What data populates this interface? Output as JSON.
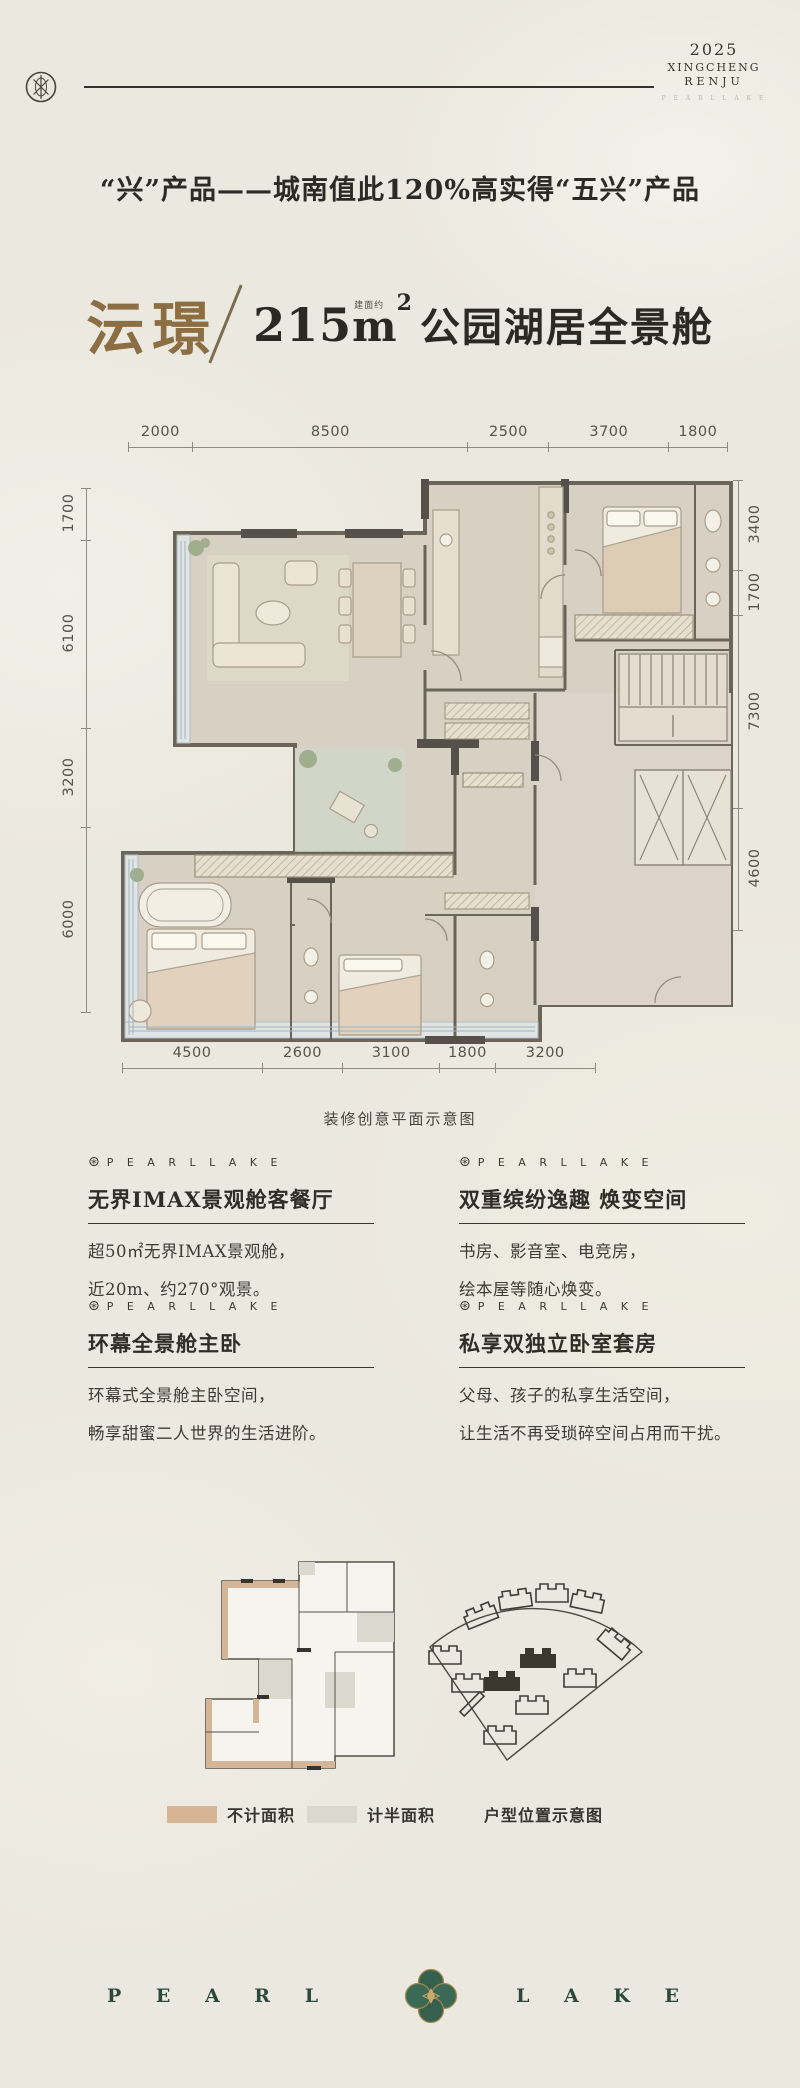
{
  "header": {
    "year": "2025",
    "brand1": "XINGCHENG",
    "brand2": "RENJU",
    "tagline": "P E A R L   L A K E"
  },
  "headline": {
    "text": "“兴”产品——城南值此120%高实得“五兴”产品"
  },
  "title": {
    "name": "沄璟",
    "area": "215",
    "area_note": "建面约",
    "unit": "m",
    "sup": "2",
    "desc": "公园湖居全景舱"
  },
  "floorplan": {
    "caption": "装修创意平面示意图",
    "dims_top": [
      "2000",
      "8500",
      "2500",
      "3700",
      "1800"
    ],
    "dims_left": [
      "1700",
      "6100",
      "3200",
      "6000"
    ],
    "dims_right": [
      "3400",
      "1700",
      "7300",
      "4600"
    ],
    "dims_bottom": [
      "4500",
      "2600",
      "3100",
      "1800",
      "3200"
    ]
  },
  "features": [
    {
      "brand": "P E A R L  L A K E",
      "title": "无界IMAX景观舱客餐厅",
      "line1": "超50㎡无界IMAX景观舱，",
      "line2": "近20m、约270°观景。"
    },
    {
      "brand": "P E A R L  L A K E",
      "title": "双重缤纷逸趣 焕变空间",
      "line1": "书房、影音室、电竞房，",
      "line2": "绘本屋等随心焕变。"
    },
    {
      "brand": "P E A R L  L A K E",
      "title": "环幕全景舱主卧",
      "line1": "环幕式全景舱主卧空间，",
      "line2": "畅享甜蜜二人世界的生活进阶。"
    },
    {
      "brand": "P E A R L  L A K E",
      "title": "私享双独立卧室套房",
      "line1": "父母、孩子的私享生活空间，",
      "line2": "让生活不再受琐碎空间占用而干扰。"
    }
  ],
  "legend": {
    "items": [
      {
        "label": "不计面积",
        "color": "#d6b596"
      },
      {
        "label": "计半面积",
        "color": "#dbd8d0"
      }
    ],
    "site_label": "户型位置示意图"
  },
  "footer": {
    "left": "P E A R L",
    "right": "L A K E"
  },
  "icons": {
    "pearl_mark": "⊛"
  },
  "colors": {
    "accent_brown": "#8c6e43",
    "footer_green": "#2c4a3c",
    "wall": "#6b6459"
  }
}
